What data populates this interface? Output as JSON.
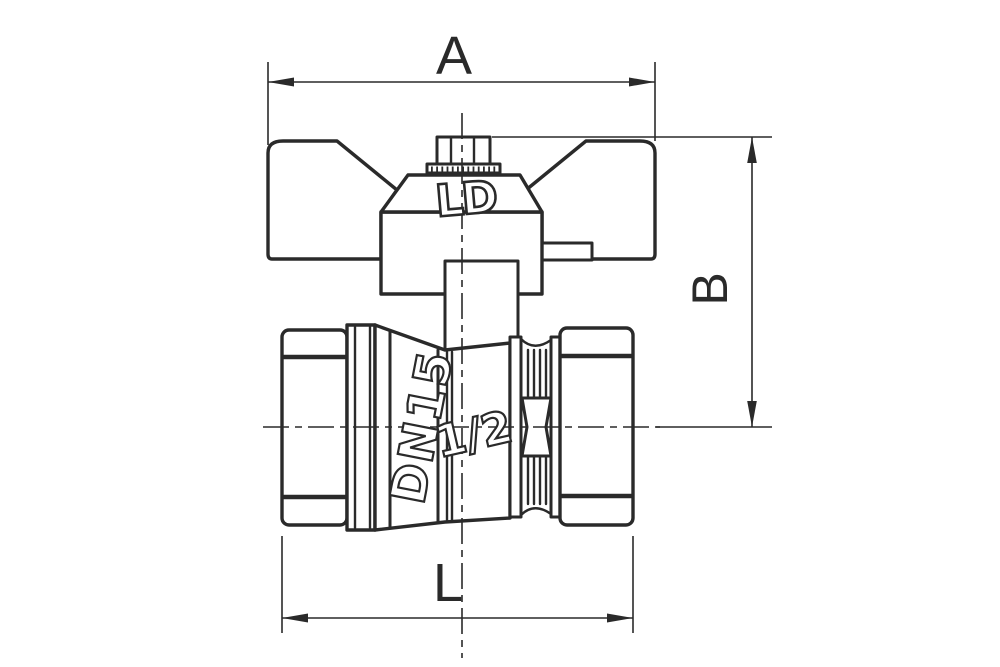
{
  "drawing": {
    "background": "#ffffff",
    "line_color": "#2a2a2a",
    "dim_labels": {
      "width": "A",
      "height": "B",
      "length": "L"
    },
    "markings": {
      "handle_logo": "LD",
      "nominal_bore": "DN15",
      "thread_size": "1/2"
    }
  }
}
